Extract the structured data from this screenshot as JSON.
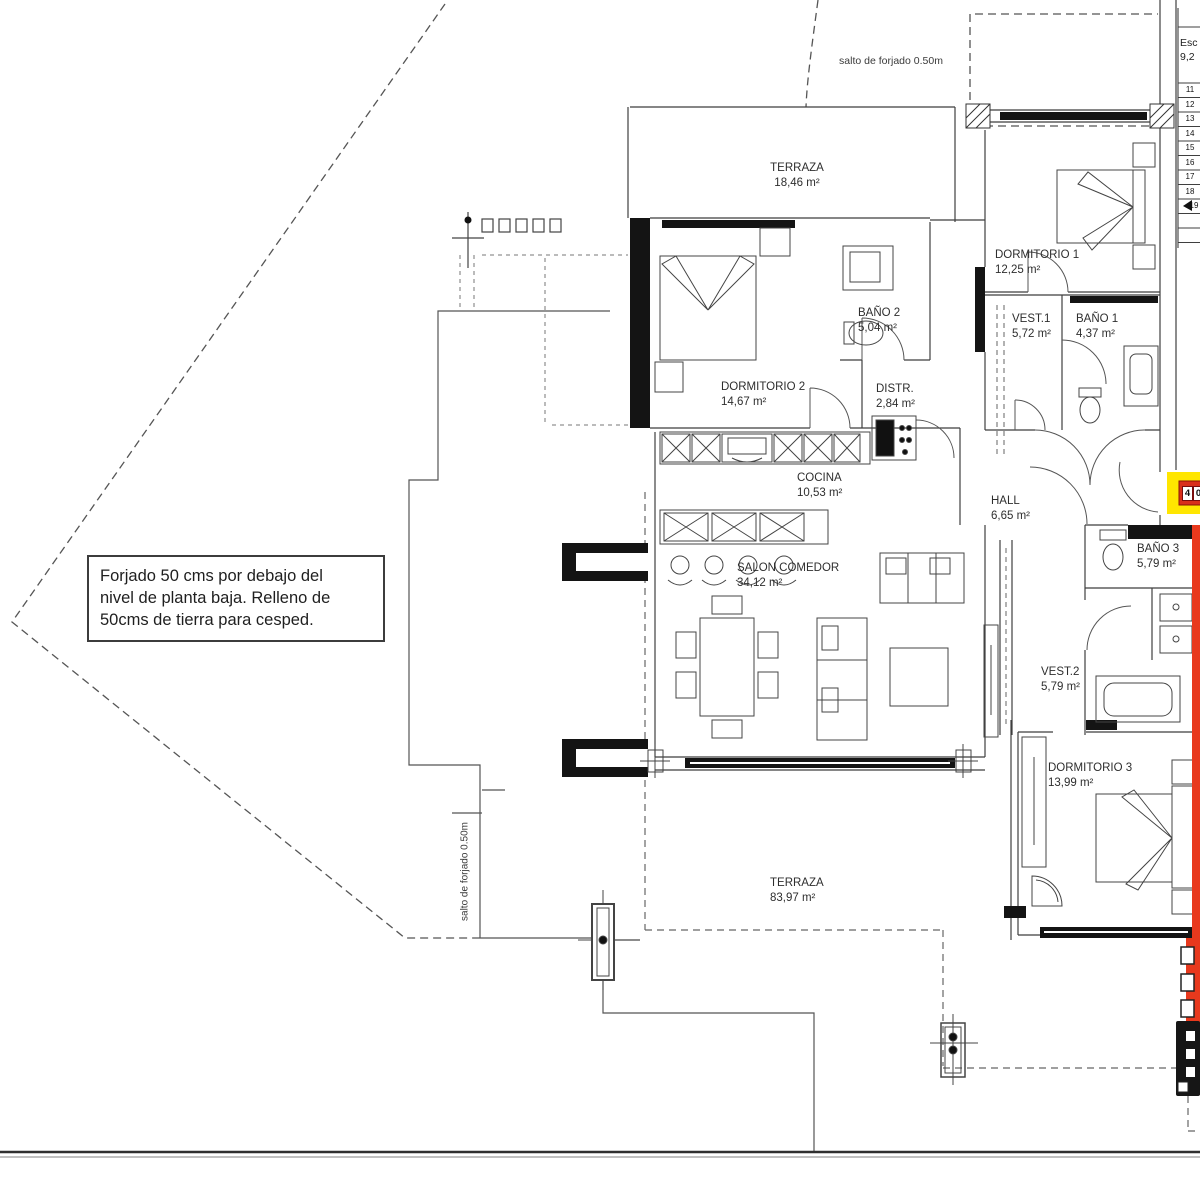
{
  "colors": {
    "highlight_red": "#e8391d",
    "highlight_yellow": "#ffe600",
    "badge_red": "#d92f1b",
    "wall": "#3f3f3f",
    "black": "#141414"
  },
  "annotations": {
    "salto_top": "salto de forjado 0.50m",
    "salto_left": "salto de forjado 0.50m",
    "note_line1": "Forjado 50 cms por debajo del",
    "note_line2": "nivel de planta baja. Relleno de",
    "note_line3": "50cms de tierra para cesped.",
    "esc_line1": "Esc",
    "esc_line2": "9,2"
  },
  "rooms": [
    {
      "name": "TERRAZA",
      "area": "18,46 m²"
    },
    {
      "name": "DORMITORIO 1",
      "area": "12,25 m²"
    },
    {
      "name": "BAÑO 2",
      "area": "5,04 m²"
    },
    {
      "name": "VEST.1",
      "area": "5,72 m²"
    },
    {
      "name": "BAÑO 1",
      "area": "4,37 m²"
    },
    {
      "name": "DORMITORIO 2",
      "area": "14,67 m²"
    },
    {
      "name": "DISTR.",
      "area": "2,84 m²"
    },
    {
      "name": "COCINA",
      "area": "10,53 m²"
    },
    {
      "name": "HALL",
      "area": "6,65 m²"
    },
    {
      "name": "SALON COMEDOR",
      "area": "34,12 m²"
    },
    {
      "name": "BAÑO 3",
      "area": "5,79 m²"
    },
    {
      "name": "VEST.2",
      "area": "5,79 m²"
    },
    {
      "name": "DORMITORIO 3",
      "area": "13,99 m²"
    },
    {
      "name": "TERRAZA",
      "area": "83,97 m²"
    }
  ],
  "stairs": {
    "numbers": [
      "11",
      "12",
      "13",
      "14",
      "15",
      "16",
      "17",
      "18",
      "19"
    ]
  },
  "unit_badge": {
    "digits": [
      "4",
      "0"
    ]
  }
}
